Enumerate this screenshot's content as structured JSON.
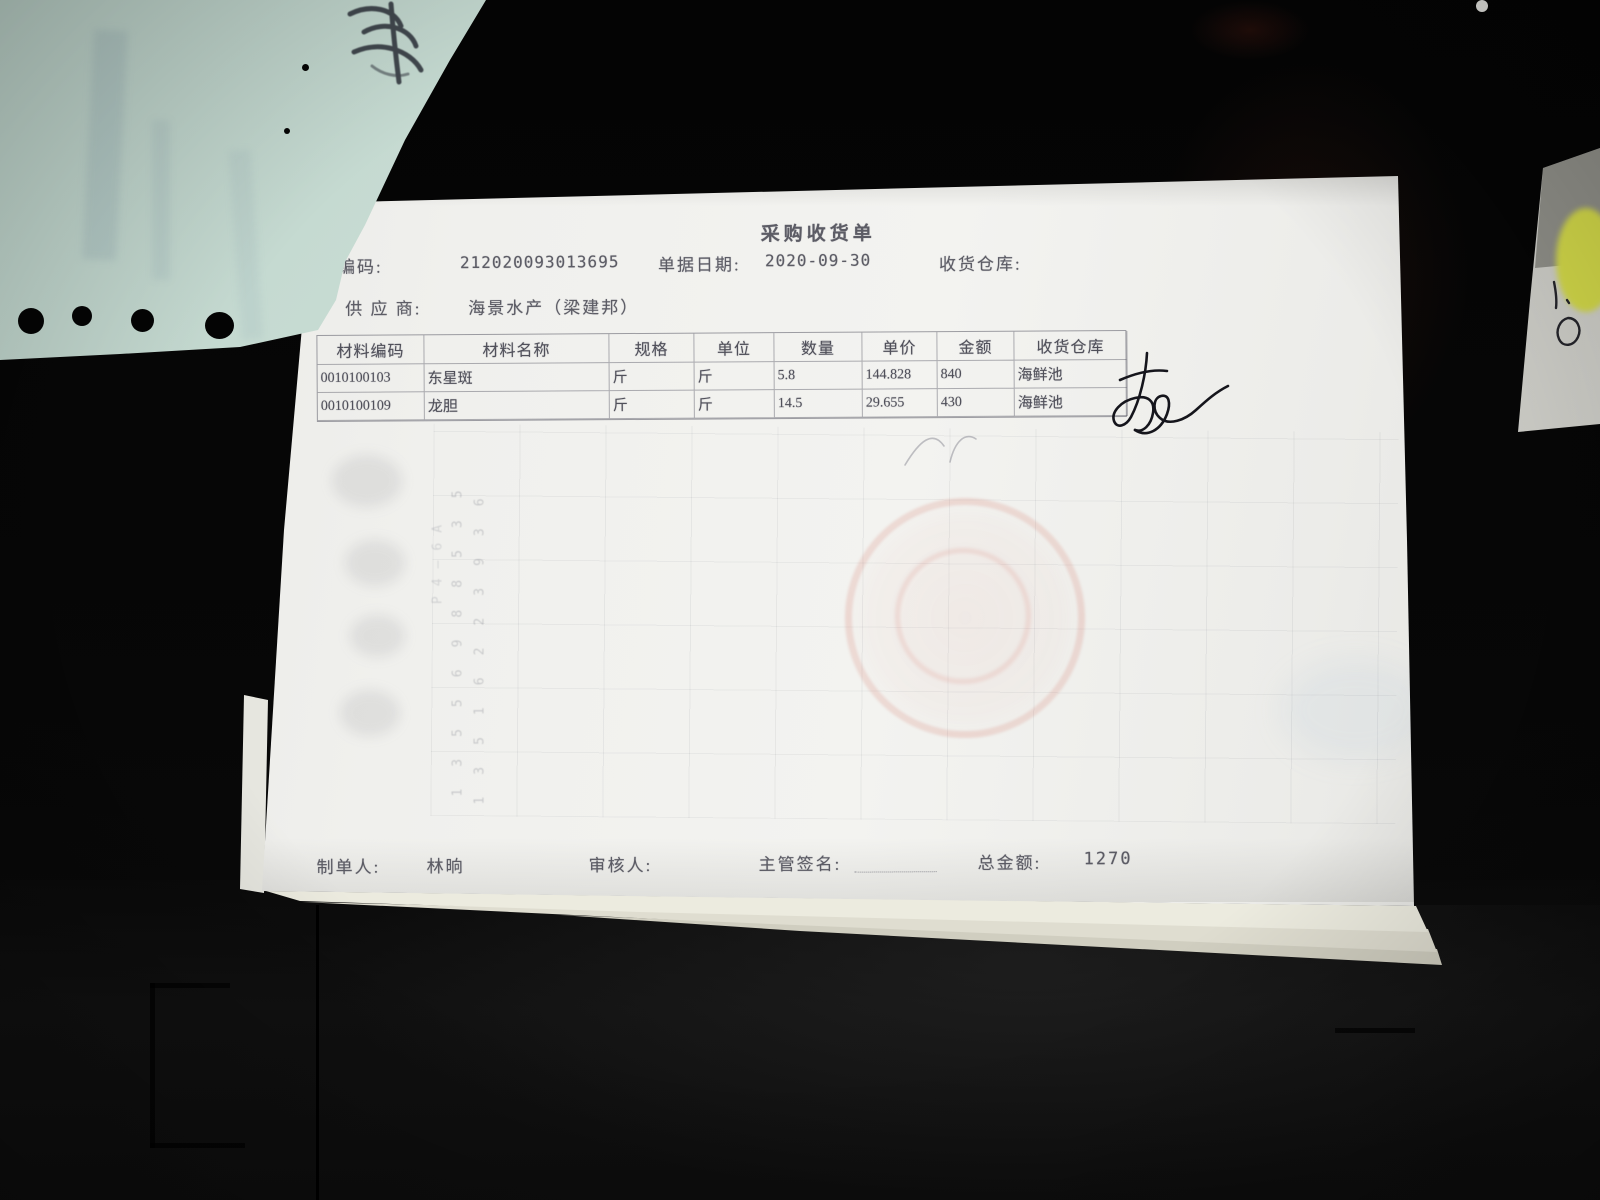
{
  "photo": {
    "description": "photo of a Chinese purchase goods-receipt slip lying on a dark desk",
    "receipt": {
      "title": "采购收货单",
      "doc_code": {
        "label": "单据编码:",
        "value": "212020093013695"
      },
      "doc_date": {
        "label": "单据日期:",
        "value": "2020-09-30"
      },
      "warehouse_label": "收货仓库:",
      "supplier": {
        "label": "供 应 商:",
        "value": "海景水产（梁建邦）"
      },
      "table": {
        "headers": [
          "材料编码",
          "材料名称",
          "规格",
          "单位",
          "数量",
          "单价",
          "金额",
          "收货仓库"
        ],
        "rows": [
          [
            "0010100103",
            "东星斑",
            "斤",
            "斤",
            "5.8",
            "144.828",
            "840",
            "海鲜池"
          ],
          [
            "0010100109",
            "龙胆",
            "斤",
            "斤",
            "14.5",
            "29.655",
            "430",
            "海鲜池"
          ]
        ]
      },
      "footer": {
        "maker_label": "制单人:",
        "maker_value": "林晌",
        "auditor_label": "审核人:",
        "sign_label": "主管签名:",
        "total_label": "总金额:",
        "total_value": "1270"
      },
      "ghost_bleedthrough": {
        "phone_1": "13556988535",
        "phone_2": "13516223936",
        "fragment": "P4—6A"
      }
    }
  }
}
